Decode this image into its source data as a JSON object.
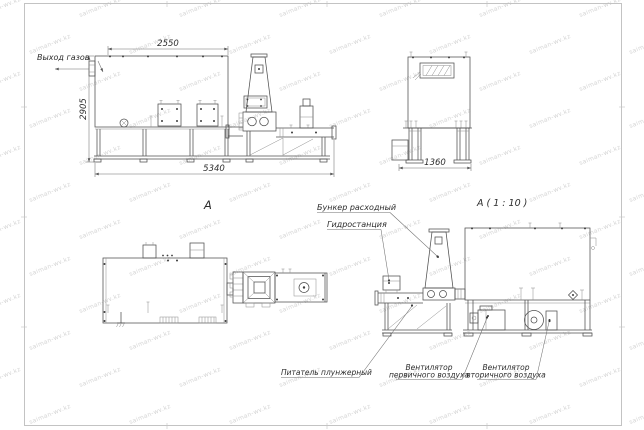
{
  "watermark": {
    "text": "saiman-wv.kz"
  },
  "labels": {
    "gas_outlet": "Выход газов",
    "view_a": "А",
    "detail_a": "А ( 1 : 10 )",
    "feed_hopper": "Бункер расходный",
    "hydraulic_station": "Гидростанция",
    "plunger_feeder": "Питатель плунжерный",
    "primary_fan": {
      "line1": "Вентилятор",
      "line2": "первичного воздуха"
    },
    "secondary_fan": {
      "line1": "Вентилятор",
      "line2": "вторичного воздуха"
    }
  },
  "dimensions": {
    "top_width": "2550",
    "left_height": "2905",
    "total_length": "5340",
    "front_width": "1360"
  }
}
